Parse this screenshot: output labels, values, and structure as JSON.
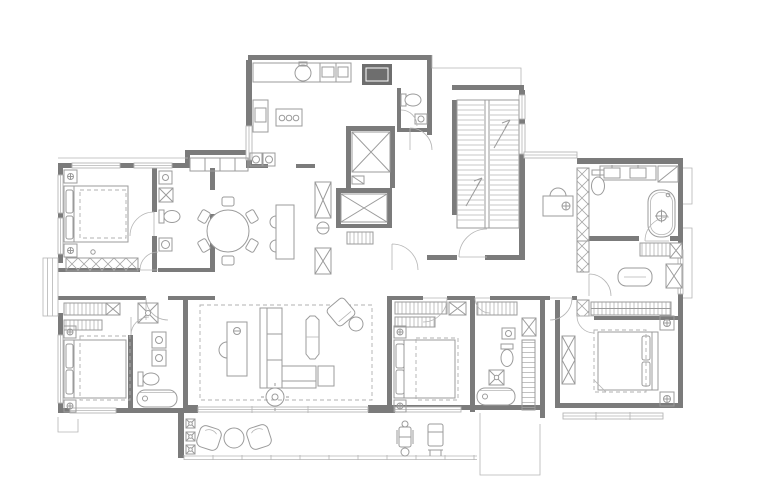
{
  "page": {
    "background": "#ffffff"
  },
  "colors": {
    "wall": "#7b7b7b",
    "wall_dark": "#6e6e6e",
    "line": "#9b9b9b",
    "line_light": "#b5b5b5",
    "dash": "#b0b0b0",
    "background": "#ffffff"
  },
  "plan": {
    "type": "residential-floor-plan",
    "style": "gray architectural line drawing on white, no labels",
    "rooms": [
      {
        "name": "kitchen",
        "features": [
          "counter",
          "round-sink",
          "cooktop",
          "pantry-cabinet",
          "washer-pair"
        ]
      },
      {
        "name": "powder-room",
        "features": [
          "toilet",
          "sink"
        ]
      },
      {
        "name": "elevator-core",
        "features": [
          "elevator-shaft",
          "elevator-shaft",
          "duct-column"
        ]
      },
      {
        "name": "foyer",
        "features": [
          "entry-door",
          "coat-rack",
          "shaft-columns"
        ]
      },
      {
        "name": "staircase-hall",
        "features": [
          "double-run-stair",
          "direction-arrows"
        ]
      },
      {
        "name": "study-nook",
        "features": [
          "desk",
          "desk-chair",
          "lamp"
        ]
      },
      {
        "name": "master-bathroom",
        "features": [
          "double-vanity",
          "bathtub",
          "toilet",
          "corner-shelf"
        ]
      },
      {
        "name": "walk-in-closet",
        "features": [
          "hanging-racks",
          "island-bench",
          "storage-box"
        ]
      },
      {
        "name": "master-bedroom",
        "features": [
          "king-bed",
          "nightstands",
          "bench"
        ]
      },
      {
        "name": "bedroom-2",
        "features": [
          "bed",
          "nightstands",
          "closet-racks"
        ]
      },
      {
        "name": "bathroom-2",
        "features": [
          "bathtub",
          "toilet",
          "sink",
          "shower",
          "linen-racks"
        ]
      },
      {
        "name": "bedroom-3",
        "features": [
          "bed",
          "nightstands",
          "wardrobe"
        ]
      },
      {
        "name": "bathroom-3",
        "features": [
          "toilet",
          "sink",
          "shower",
          "washer"
        ]
      },
      {
        "name": "bedroom-4",
        "features": [
          "bed",
          "nightstands",
          "closet-racks"
        ]
      },
      {
        "name": "bathroom-4",
        "features": [
          "bathtub",
          "double-sink",
          "toilet",
          "shower"
        ]
      },
      {
        "name": "dining-area",
        "features": [
          "round-table",
          "six-chairs",
          "island-counter",
          "two-stools",
          "sideboard"
        ]
      },
      {
        "name": "living-room",
        "features": [
          "l-sofa",
          "coffee-table",
          "armchair",
          "side-table",
          "desk",
          "desk-chair",
          "ceiling-fan"
        ]
      },
      {
        "name": "terrace",
        "features": [
          "lounge-chair",
          "round-table",
          "lounge-chair",
          "exercise-bike",
          "deck-chair",
          "railing",
          "drain-markers"
        ]
      },
      {
        "name": "bay-window",
        "features": []
      },
      {
        "name": "corridor",
        "features": [
          "door-swings"
        ]
      }
    ]
  }
}
